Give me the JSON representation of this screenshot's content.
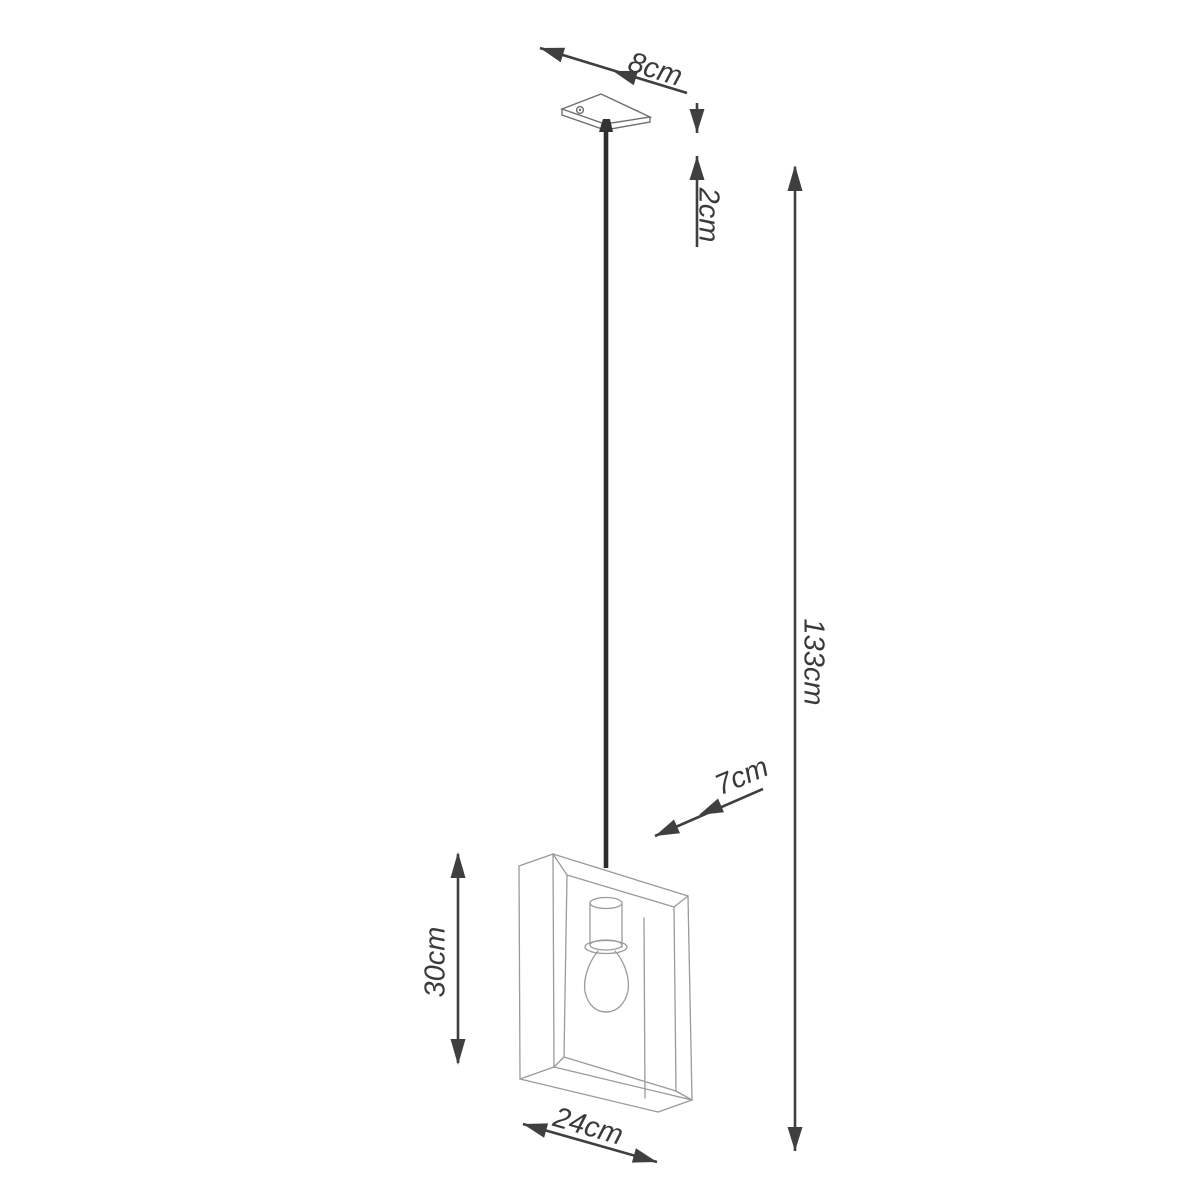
{
  "diagram": {
    "labels": {
      "canopy_width": "8cm",
      "canopy_height": "2cm",
      "overall_height": "133cm",
      "frame_depth": "7cm",
      "frame_height": "30cm",
      "frame_width": "24cm"
    },
    "colors": {
      "background": "#ffffff",
      "dimension_lines": "#3f3f3f",
      "label_text": "#3a3a3a",
      "product_outline": "#9a9a9a",
      "canopy_outline": "#6f6f6f",
      "cable": "#2c2c2c"
    }
  }
}
